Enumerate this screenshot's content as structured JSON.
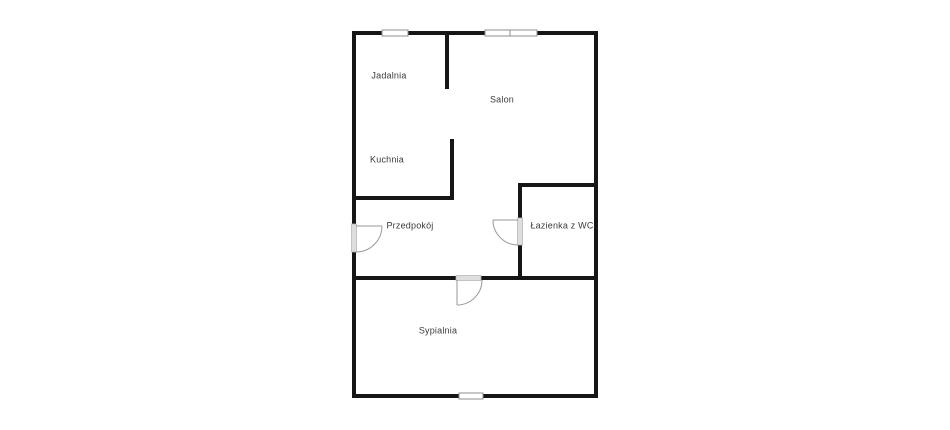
{
  "page": {
    "title": "Floor plan"
  },
  "floorplan": {
    "canvas": {
      "width": 950,
      "height": 430
    },
    "colors": {
      "background": "#ffffff",
      "wall": "#161616",
      "window_fill": "#ffffff",
      "window_border": "#8f8f8f",
      "door_frame_fill": "#dedede",
      "door_frame_border": "#b5b5b5",
      "door_stroke": "#979797",
      "label": "#3b3b3b"
    },
    "walls": [
      {
        "name": "outer-top",
        "x": 352,
        "y": 31,
        "w": 246,
        "h": 4
      },
      {
        "name": "outer-bottom",
        "x": 352,
        "y": 394,
        "w": 246,
        "h": 4
      },
      {
        "name": "outer-left-upper",
        "x": 352,
        "y": 31,
        "w": 4,
        "h": 193
      },
      {
        "name": "outer-left-lower",
        "x": 352,
        "y": 252,
        "w": 4,
        "h": 146
      },
      {
        "name": "outer-right",
        "x": 594,
        "y": 31,
        "w": 4,
        "h": 367
      },
      {
        "name": "jadalnia-salon-divider",
        "x": 445,
        "y": 35,
        "w": 4,
        "h": 54
      },
      {
        "name": "kuchnia-right",
        "x": 450,
        "y": 139,
        "w": 4,
        "h": 61
      },
      {
        "name": "kuchnia-bottom",
        "x": 356,
        "y": 196,
        "w": 98,
        "h": 4
      },
      {
        "name": "lazienka-top",
        "x": 518,
        "y": 183,
        "w": 76,
        "h": 4
      },
      {
        "name": "lazienka-left-upper",
        "x": 518,
        "y": 187,
        "w": 4,
        "h": 33
      },
      {
        "name": "lazienka-left-lower",
        "x": 518,
        "y": 245,
        "w": 4,
        "h": 35
      },
      {
        "name": "hall-sypialnia-west",
        "x": 356,
        "y": 276,
        "w": 100,
        "h": 4
      },
      {
        "name": "hall-sypialnia-east",
        "x": 481,
        "y": 276,
        "w": 113,
        "h": 4
      }
    ],
    "windows": [
      {
        "name": "jadalnia-window",
        "x": 382,
        "y": 30,
        "w": 26,
        "h": 6
      },
      {
        "name": "salon-window-left",
        "x": 485,
        "y": 30,
        "w": 25,
        "h": 6
      },
      {
        "name": "salon-window-right",
        "x": 510,
        "y": 30,
        "w": 27,
        "h": 6
      },
      {
        "name": "sypialnia-window",
        "x": 459,
        "y": 393,
        "w": 24,
        "h": 6
      }
    ],
    "doors": [
      {
        "name": "entrance-door",
        "frame": {
          "x": 351.5,
          "y": 224,
          "w": 5,
          "h": 28
        },
        "leaf": {
          "x1": 356,
          "y1": 226,
          "x2": 382,
          "y2": 226
        },
        "arc": {
          "sx": 382,
          "sy": 226,
          "r": 26,
          "ex": 356,
          "ey": 252,
          "sweep": 1
        }
      },
      {
        "name": "lazienka-door",
        "frame": {
          "x": 517.5,
          "y": 218,
          "w": 5,
          "h": 27
        },
        "leaf": {
          "x1": 518,
          "y1": 220,
          "x2": 493,
          "y2": 220
        },
        "arc": {
          "sx": 493,
          "sy": 220,
          "r": 25,
          "ex": 518,
          "ey": 245,
          "sweep": 0
        }
      },
      {
        "name": "sypialnia-door",
        "frame": {
          "x": 456,
          "y": 275.5,
          "w": 25,
          "h": 5
        },
        "leaf": {
          "x1": 457,
          "y1": 280,
          "x2": 457,
          "y2": 305
        },
        "arc": {
          "sx": 457,
          "sy": 305,
          "r": 25,
          "ex": 482,
          "ey": 280,
          "sweep": 0
        }
      }
    ],
    "rooms": [
      {
        "id": "jadalnia",
        "label": "Jadalnia",
        "x": 389,
        "y": 76
      },
      {
        "id": "salon",
        "label": "Salon",
        "x": 502,
        "y": 100
      },
      {
        "id": "kuchnia",
        "label": "Kuchnia",
        "x": 387,
        "y": 160
      },
      {
        "id": "przedpokoj",
        "label": "Przedpokój",
        "x": 410,
        "y": 226
      },
      {
        "id": "lazienka",
        "label": "Łazienka z WC",
        "x": 562,
        "y": 226
      },
      {
        "id": "sypialnia",
        "label": "Sypialnia",
        "x": 438,
        "y": 331
      }
    ]
  }
}
